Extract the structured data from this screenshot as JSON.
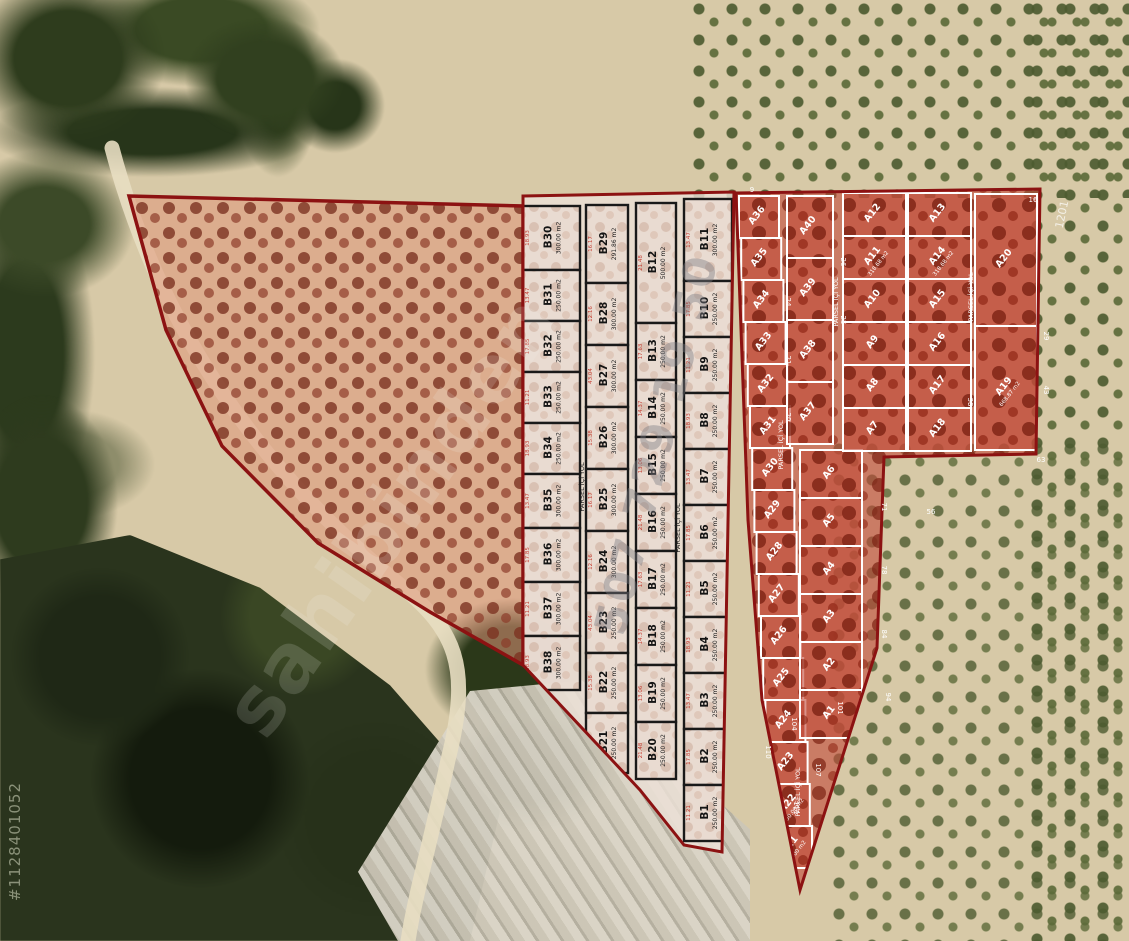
{
  "watermarks": {
    "brand": "sahibinden",
    "phone": "507 729 19 50",
    "listing_id": "#1128401052"
  },
  "map_labels": {
    "plot_code": "1201"
  },
  "overlay": {
    "road_label": "PARSEL İÇİ YOL"
  },
  "colors": {
    "boundary_red": "#8c1212",
    "b_grid_line": "#191919",
    "a_grid_line": "#ffffff"
  },
  "b_block": {
    "columns": [
      {
        "name": "col-1",
        "parcels": [
          {
            "id": "B30",
            "area": "300.00 m2"
          },
          {
            "id": "B31",
            "area": "250.00 m2"
          },
          {
            "id": "B32",
            "area": "250.00 m2"
          },
          {
            "id": "B33",
            "area": "250.00 m2"
          },
          {
            "id": "B34",
            "area": "250.00 m2"
          },
          {
            "id": "B35",
            "area": "300.00 m2"
          },
          {
            "id": "B36",
            "area": "300.00 m2"
          },
          {
            "id": "B37",
            "area": "300.00 m2"
          },
          {
            "id": "B38",
            "area": "300.00 m2"
          }
        ]
      },
      {
        "name": "col-2",
        "parcels": [
          {
            "id": "B29",
            "area": "291.86 m2"
          },
          {
            "id": "B28",
            "area": "300.00 m2"
          },
          {
            "id": "B27",
            "area": "300.00 m2"
          },
          {
            "id": "B26",
            "area": "300.00 m2"
          },
          {
            "id": "B25",
            "area": "300.00 m2"
          },
          {
            "id": "B24",
            "area": "300.00 m2"
          },
          {
            "id": "B23",
            "area": "250.00 m2"
          },
          {
            "id": "B22",
            "area": "250.00 m2"
          },
          {
            "id": "B21",
            "area": "250.00 m2"
          }
        ]
      },
      {
        "name": "col-3",
        "parcels": [
          {
            "id": "B12",
            "area": "500.00 m2"
          },
          {
            "id": "B13",
            "area": "250.00 m2"
          },
          {
            "id": "B14",
            "area": "250.00 m2"
          },
          {
            "id": "B15",
            "area": "250.00 m2"
          },
          {
            "id": "B16",
            "area": "250.00 m2"
          },
          {
            "id": "B17",
            "area": "250.00 m2"
          },
          {
            "id": "B18",
            "area": "250.00 m2"
          },
          {
            "id": "B19",
            "area": "250.00 m2"
          },
          {
            "id": "B20",
            "area": "250.00 m2"
          }
        ]
      },
      {
        "name": "col-4",
        "parcels": [
          {
            "id": "B11",
            "area": "300.00 m2"
          },
          {
            "id": "B10",
            "area": "250.00 m2"
          },
          {
            "id": "B9",
            "area": "250.00 m2"
          },
          {
            "id": "B8",
            "area": "250.00 m2"
          },
          {
            "id": "B7",
            "area": "250.00 m2"
          },
          {
            "id": "B6",
            "area": "250.00 m2"
          },
          {
            "id": "B5",
            "area": "250.00 m2"
          },
          {
            "id": "B4",
            "area": "250.00 m2"
          },
          {
            "id": "B3",
            "area": "250.00 m2"
          },
          {
            "id": "B2",
            "area": "250.00 m2"
          },
          {
            "id": "B1",
            "area": "250.00 m2"
          }
        ]
      }
    ]
  },
  "a_block": {
    "columns": [
      {
        "name": "left-column",
        "parcels": [
          {
            "id": "A36",
            "area": ""
          },
          {
            "id": "A35",
            "area": ""
          },
          {
            "id": "A34",
            "area": ""
          },
          {
            "id": "A33",
            "area": ""
          },
          {
            "id": "A32",
            "area": ""
          },
          {
            "id": "A31",
            "area": ""
          },
          {
            "id": "A30",
            "area": ""
          },
          {
            "id": "A29",
            "area": ""
          },
          {
            "id": "A28",
            "area": ""
          },
          {
            "id": "A27",
            "area": ""
          },
          {
            "id": "A26",
            "area": ""
          },
          {
            "id": "A25",
            "area": ""
          },
          {
            "id": "A24",
            "area": ""
          },
          {
            "id": "A23",
            "area": ""
          },
          {
            "id": "A22",
            "area": "250.00 m2"
          },
          {
            "id": "A21",
            "area": "250.00 m2"
          }
        ]
      },
      {
        "name": "upper-mid-column",
        "parcels": [
          {
            "id": "A40",
            "area": ""
          },
          {
            "id": "A39",
            "area": ""
          },
          {
            "id": "A38",
            "area": ""
          },
          {
            "id": "A37",
            "area": ""
          }
        ]
      },
      {
        "name": "lower-mid-column",
        "parcels": [
          {
            "id": "A6",
            "area": ""
          },
          {
            "id": "A5",
            "area": ""
          },
          {
            "id": "A4",
            "area": ""
          },
          {
            "id": "A3",
            "area": ""
          },
          {
            "id": "A2",
            "area": ""
          },
          {
            "id": "A1",
            "area": ""
          }
        ]
      },
      {
        "name": "grid-left-column",
        "parcels": [
          {
            "id": "A12",
            "area": ""
          },
          {
            "id": "A11",
            "area": "318.68 m2"
          },
          {
            "id": "A10",
            "area": ""
          },
          {
            "id": "A9",
            "area": ""
          },
          {
            "id": "A8",
            "area": ""
          },
          {
            "id": "A7",
            "area": ""
          }
        ]
      },
      {
        "name": "grid-right-column",
        "parcels": [
          {
            "id": "A13",
            "area": ""
          },
          {
            "id": "A14",
            "area": "318.68 m2"
          },
          {
            "id": "A15",
            "area": ""
          },
          {
            "id": "A16",
            "area": ""
          },
          {
            "id": "A17",
            "area": ""
          },
          {
            "id": "A18",
            "area": ""
          }
        ]
      },
      {
        "name": "right-column",
        "parcels": [
          {
            "id": "A20",
            "area": ""
          },
          {
            "id": "A19",
            "area": "668.87 m2"
          }
        ]
      }
    ]
  },
  "edge_dims": [
    "9",
    "24",
    "21",
    "20",
    "26",
    "25",
    "16",
    "29",
    "43",
    "63",
    "38",
    "56",
    "71",
    "78",
    "84",
    "94",
    "101",
    "104",
    "107",
    "110",
    "111"
  ],
  "b_dims": [
    "18.93",
    "17.63",
    "15.38",
    "13.47",
    "14.37",
    "16.17",
    "17.85",
    "13.06",
    "12.16",
    "11.21",
    "21.48",
    "43.04"
  ]
}
